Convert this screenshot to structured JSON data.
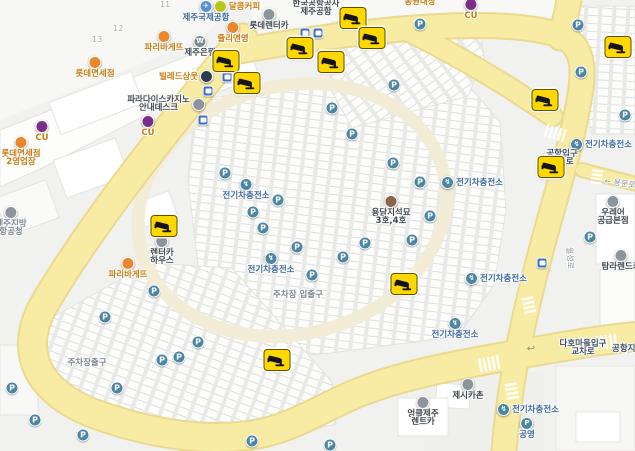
{
  "map": {
    "glyphs": {
      "parking": "P",
      "ev": "↯",
      "uturn_arrow": "↩"
    },
    "colors": {
      "road_fill": "#F8ECA4",
      "road_casing": "#EADA90",
      "inner_loop": "#F3EDD7",
      "background": "#F1F1EF",
      "parking_icon": "#4B86A4",
      "bus_icon": "#3F6EC6",
      "cctv_badge": "#FFD800",
      "orange_label": "#C87C14",
      "dark_label": "#40484F",
      "blue_label": "#3E699F"
    },
    "pois": [
      {
        "id": "dalkomm-coffee",
        "lines": [
          "달콤커피"
        ],
        "x": 237,
        "y": 0,
        "color": "orange",
        "icon": {
          "name": "coffee-shop",
          "bg": "#B9C418",
          "glyph": "",
          "pos": "left"
        }
      },
      {
        "id": "jeju-intl-airport",
        "lines": [
          "제주국제공항"
        ],
        "x": 206,
        "y": 0,
        "color": "blue",
        "icon": {
          "name": "airport",
          "bg": "#5B8ED6",
          "glyph": "✈",
          "pos": "above"
        }
      },
      {
        "id": "korea-airports-corp-jeju",
        "lines": [
          "한국공항공사",
          "제주공항"
        ],
        "x": 316,
        "y": 0,
        "color": "dark"
      },
      {
        "id": "lotte-rentacar",
        "lines": [
          "롯데렌터카"
        ],
        "x": 269,
        "y": 8,
        "color": "dark",
        "icon": {
          "name": "rentacar",
          "bg": "#8C959D",
          "glyph": "",
          "pos": "above"
        }
      },
      {
        "id": "julie-and-young",
        "lines": [
          "쥴리앤영"
        ],
        "x": 233,
        "y": 21,
        "color": "orange",
        "icon": {
          "name": "shop",
          "bg": "#E8872B",
          "glyph": "",
          "pos": "above"
        }
      },
      {
        "id": "jeju-bank",
        "lines": [
          "제주은행"
        ],
        "x": 200,
        "y": 35,
        "color": "dark",
        "icon": {
          "name": "bank",
          "bg": "#7D8894",
          "glyph": "₩",
          "pos": "above"
        }
      },
      {
        "id": "paris-baguette-1",
        "lines": [
          "파리바게뜨"
        ],
        "x": 164,
        "y": 30,
        "color": "orange",
        "icon": {
          "name": "bakery",
          "bg": "#E8872B",
          "glyph": "",
          "pos": "above"
        }
      },
      {
        "id": "lotte-duty-free",
        "lines": [
          "롯데면세점"
        ],
        "x": 95,
        "y": 56,
        "color": "orange",
        "icon": {
          "name": "duty-free",
          "bg": "#E8872B",
          "glyph": "",
          "pos": "above"
        }
      },
      {
        "id": "ville-de-sangut",
        "lines": [
          "빌레드상웃"
        ],
        "x": 186,
        "y": 70,
        "color": "orange",
        "icon": {
          "name": "hotel",
          "bg": "#2C3A52",
          "glyph": "",
          "pos": "right"
        }
      },
      {
        "id": "paradise-casino-info-desk",
        "lines": [
          "파라다이스카지노",
          "안내데스크"
        ],
        "x": 166,
        "y": 96,
        "color": "dark",
        "icon": {
          "name": "casino-info",
          "bg": "#8C959D",
          "glyph": "",
          "pos": "right"
        }
      },
      {
        "id": "cu-store-1",
        "lines": [
          "CU"
        ],
        "x": 148,
        "y": 115,
        "color": "orange",
        "icon": {
          "name": "convenience-store",
          "bg": "#7B2D8B",
          "glyph": "",
          "pos": "above"
        }
      },
      {
        "id": "cu-store-2",
        "lines": [
          "CU"
        ],
        "x": 42,
        "y": 120,
        "color": "orange",
        "icon": {
          "name": "convenience-store",
          "bg": "#7B2D8B",
          "glyph": "",
          "pos": "above"
        }
      },
      {
        "id": "cu-store-3",
        "lines": [
          "CU"
        ],
        "x": 471,
        "y": -2,
        "color": "orange",
        "icon": {
          "name": "convenience-store",
          "bg": "#7B2D8B",
          "glyph": "",
          "pos": "above"
        }
      },
      {
        "id": "dongwon-daejang",
        "lines": [
          "동원대장"
        ],
        "x": 420,
        "y": -2,
        "color": "orange"
      },
      {
        "id": "lotte-duty-free-branch2",
        "lines": [
          "롯데면세점",
          "2영업장"
        ],
        "x": 21,
        "y": 136,
        "color": "orange",
        "icon": {
          "name": "duty-free",
          "bg": "#E8872B",
          "glyph": "",
          "pos": "above"
        }
      },
      {
        "id": "jeju-regional-aviation-office",
        "lines": [
          "제주지방",
          "항공청"
        ],
        "x": 11,
        "y": 206,
        "color": "gray",
        "icon": {
          "name": "government-office",
          "bg": "#8C959D",
          "glyph": "",
          "pos": "above"
        }
      },
      {
        "id": "rentacar-house",
        "lines": [
          "렌터카",
          "하우스"
        ],
        "x": 162,
        "y": 235,
        "color": "dark",
        "icon": {
          "name": "rentacar",
          "bg": "#8C959D",
          "glyph": "",
          "pos": "above"
        }
      },
      {
        "id": "paris-baguette-2",
        "lines": [
          "파리바게뜨"
        ],
        "x": 128,
        "y": 257,
        "color": "orange",
        "icon": {
          "name": "bakery",
          "bg": "#E8872B",
          "glyph": "",
          "pos": "above"
        }
      },
      {
        "id": "yongdam-dolmen-3-4",
        "lines": [
          "용담지석묘",
          "3호,4호"
        ],
        "x": 391,
        "y": 195,
        "color": "dark",
        "icon": {
          "name": "heritage-site",
          "bg": "#8A6648",
          "glyph": "",
          "pos": "above"
        }
      },
      {
        "id": "jessica-chon",
        "lines": [
          "제시카촌"
        ],
        "x": 468,
        "y": 378,
        "color": "dark",
        "icon": {
          "name": "restaurant",
          "bg": "#8C959D",
          "glyph": "",
          "pos": "above"
        }
      },
      {
        "id": "uncle-jeju-rentacar",
        "lines": [
          "엉클제주",
          "렌트카"
        ],
        "x": 423,
        "y": 396,
        "color": "dark",
        "icon": {
          "name": "rentacar",
          "bg": "#8C959D",
          "glyph": "",
          "pos": "above"
        }
      },
      {
        "id": "tamna-rentacar",
        "lines": [
          "탐라렌드카"
        ],
        "x": 621,
        "y": 249,
        "color": "dark",
        "icon": {
          "name": "rentacar",
          "bg": "#8C959D",
          "glyph": "",
          "pos": "above"
        }
      },
      {
        "id": "urea-supply-main",
        "lines": [
          "우레어",
          "공급본점"
        ],
        "x": 613,
        "y": 195,
        "color": "dark",
        "icon": {
          "name": "store",
          "bg": "#8C959D",
          "glyph": "",
          "pos": "above"
        }
      },
      {
        "id": "public-parking",
        "lines": [
          "공영"
        ],
        "x": 527,
        "y": 417,
        "color": "blue",
        "icon": {
          "name": "parking",
          "bg": "#4B86A4",
          "glyph": "P",
          "pos": "above"
        }
      },
      {
        "id": "ev-charging-station-1",
        "lines": [
          "전기차충전소"
        ],
        "x": 246,
        "y": 178,
        "color": "blue",
        "icon": {
          "name": "ev-charger",
          "bg": "#4B86A4",
          "glyph": "↯",
          "pos": "above"
        }
      },
      {
        "id": "ev-charging-station-2",
        "lines": [
          "전기차충전소"
        ],
        "x": 271,
        "y": 252,
        "color": "blue",
        "icon": {
          "name": "ev-charger",
          "bg": "#4B86A4",
          "glyph": "↯",
          "pos": "above"
        }
      },
      {
        "id": "ev-charging-station-3",
        "lines": [
          "전기차충전소"
        ],
        "x": 472,
        "y": 176,
        "color": "blue",
        "icon": {
          "name": "ev-charger",
          "bg": "#4B86A4",
          "glyph": "↯",
          "pos": "left"
        }
      },
      {
        "id": "ev-charging-station-4",
        "lines": [
          "전기차충전소"
        ],
        "x": 601,
        "y": 138,
        "color": "blue",
        "icon": {
          "name": "ev-charger",
          "bg": "#4B86A4",
          "glyph": "↯",
          "pos": "left"
        }
      },
      {
        "id": "ev-charging-station-5",
        "lines": [
          "전기차충전소"
        ],
        "x": 496,
        "y": 272,
        "color": "blue",
        "icon": {
          "name": "ev-charger",
          "bg": "#4B86A4",
          "glyph": "↯",
          "pos": "left"
        }
      },
      {
        "id": "ev-charging-station-6",
        "lines": [
          "전기차충전소"
        ],
        "x": 455,
        "y": 317,
        "color": "blue",
        "icon": {
          "name": "ev-charger",
          "bg": "#4B86A4",
          "glyph": "↯",
          "pos": "above"
        }
      },
      {
        "id": "ev-charging-station-7",
        "lines": [
          "전기차충전소"
        ],
        "x": 528,
        "y": 403,
        "color": "blue",
        "icon": {
          "name": "ev-charger",
          "bg": "#4B86A4",
          "glyph": "↯",
          "pos": "left"
        }
      },
      {
        "id": "airport-entrance-intersection",
        "lines": [
          "공항입구",
          "교차로"
        ],
        "x": 562,
        "y": 150,
        "color": "navy"
      },
      {
        "id": "daho-village-entrance-intersection",
        "lines": [
          "다호마을입구",
          "교차로"
        ],
        "x": 583,
        "y": 340,
        "color": "navy"
      },
      {
        "id": "airport-underpass",
        "lines": [
          "공항지하차도"
        ],
        "x": 612,
        "y": 345,
        "color": "navy",
        "anchor": "start"
      },
      {
        "id": "parking-lot-exit-label",
        "lines": [
          "주차장출구"
        ],
        "x": 87,
        "y": 359,
        "color": "gray"
      },
      {
        "id": "parking-lot-entrance-exit-label",
        "lines": [
          "주차장 입출구"
        ],
        "x": 298,
        "y": 291,
        "color": "gray"
      }
    ],
    "cctv": [
      [
        226,
        61
      ],
      [
        247,
        83
      ],
      [
        300,
        48
      ],
      [
        331,
        62
      ],
      [
        353,
        18
      ],
      [
        372,
        38
      ],
      [
        618,
        47
      ],
      [
        545,
        100
      ],
      [
        551,
        167
      ],
      [
        404,
        284
      ],
      [
        277,
        360
      ],
      [
        164,
        226
      ]
    ],
    "parking_icons": [
      [
        420,
        24
      ],
      [
        332,
        108
      ],
      [
        352,
        134
      ],
      [
        394,
        85
      ],
      [
        578,
        25
      ],
      [
        581,
        72
      ],
      [
        625,
        115
      ],
      [
        393,
        163
      ],
      [
        225,
        173
      ],
      [
        278,
        200
      ],
      [
        253,
        212
      ],
      [
        263,
        228
      ],
      [
        297,
        247
      ],
      [
        312,
        275
      ],
      [
        343,
        257
      ],
      [
        365,
        243
      ],
      [
        420,
        182
      ],
      [
        430,
        216
      ],
      [
        412,
        240
      ],
      [
        590,
        237
      ],
      [
        154,
        291
      ],
      [
        105,
        317
      ],
      [
        198,
        342
      ],
      [
        179,
        357
      ],
      [
        162,
        360
      ],
      [
        117,
        388
      ],
      [
        12,
        388
      ],
      [
        35,
        420
      ],
      [
        83,
        435
      ],
      [
        252,
        441
      ],
      [
        330,
        445
      ]
    ],
    "bus_stops": [
      [
        305,
        33
      ],
      [
        318,
        33
      ],
      [
        227,
        77
      ],
      [
        208,
        91
      ],
      [
        203,
        120
      ],
      [
        542,
        263
      ]
    ],
    "road_labels": [
      {
        "id": "yongmun-ro",
        "text": "← 용문로",
        "x": 620,
        "y": 183,
        "rot": 8
      },
      {
        "id": "wolseong-ro",
        "text": "월성로",
        "x": 570,
        "y": 258,
        "rot": 87
      }
    ],
    "road_marks": [
      {
        "glyph": "↩",
        "x": 531,
        "y": 349
      }
    ],
    "plot_numbers": [
      {
        "text": "11",
        "x": 160,
        "y": 0
      },
      {
        "text": "12",
        "x": 113,
        "y": 24
      },
      {
        "text": "13",
        "x": 92,
        "y": 35
      }
    ]
  }
}
